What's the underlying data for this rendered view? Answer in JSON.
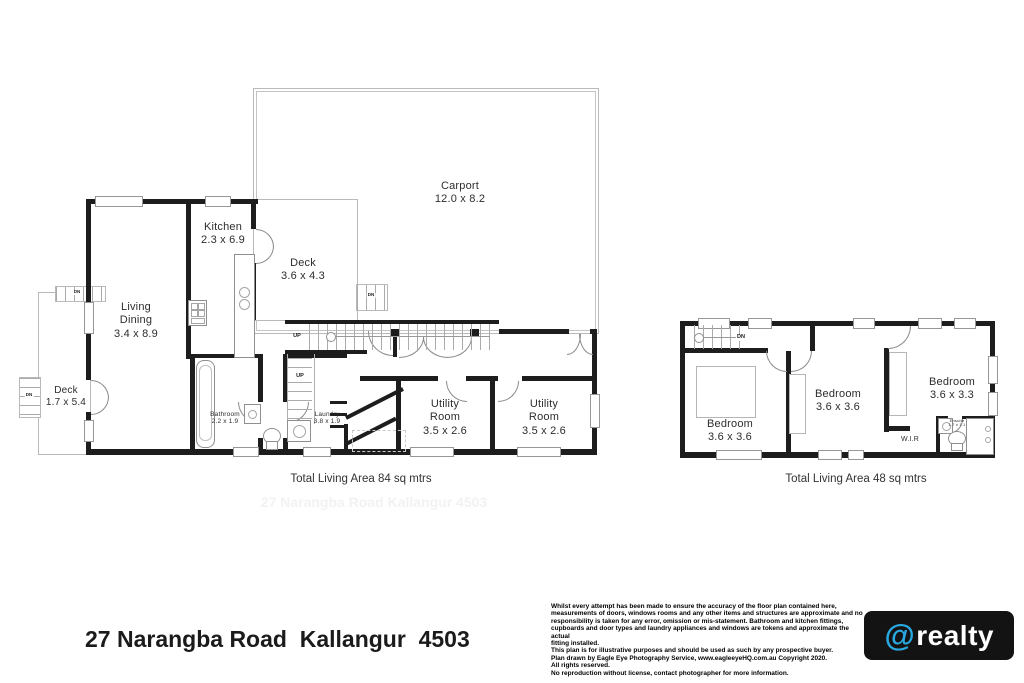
{
  "ground": {
    "carport": "Carport\n12.0 x 8.2",
    "kitchen": "Kitchen\n2.3 x 6.9",
    "deck_top": "Deck\n3.6 x 4.3",
    "living": "Living\nDining\n3.4 x 8.9",
    "deck_left": "Deck\n1.7 x 5.4",
    "bathroom": "Bathroom\n2.2 x 1.9",
    "laundry": "Laundry\n3.8 x 1.9",
    "utility1": "Utility\nRoom\n3.5 x 2.6",
    "utility2": "Utility\nRoom\n3.5 x 2.6",
    "up": "UP",
    "dn": "DN",
    "total": "Total Living Area 84 sq mtrs",
    "watermark": "27 Narangba Road  Kallangur  4503"
  },
  "upper": {
    "bedroom1": "Bedroom\n3.6 x 3.6",
    "bedroom2": "Bedroom\n3.6 x 3.6",
    "bedroom3": "Bedroom\n3.6 x 3.3",
    "wir": "W.I.R",
    "ensuite": "Ensuite\n1.7 x 1.1",
    "dn": "DN",
    "total": "Total Living Area 48 sq mtrs"
  },
  "footer": {
    "address": "27 Narangba Road  Kallangur  4503",
    "disclaimer": [
      "Whilst every attempt has been made to ensure the accuracy of the floor plan contained here,",
      "measurements of doors, windows rooms and any other items and structures are approximate and no",
      "responsibility is taken for any error, omission or mis-statement. Bathroom and kitchen fittings,",
      "cupboards and door types and laundry appliances and windows are tokens and approximate the actual",
      "fitting installed.",
      "This plan is for illustrative purposes and should be used as such by any prospective buyer.",
      "Plan drawn by Eagle Eye Photography Service, www.eagleeyeHQ.com.au Copyright 2020.",
      "All rights reserved.",
      "No reproduction without license, contact photographer for more information."
    ],
    "logo_at": "@",
    "logo_text": "realty",
    "accent_color": "#2aa9e0"
  }
}
